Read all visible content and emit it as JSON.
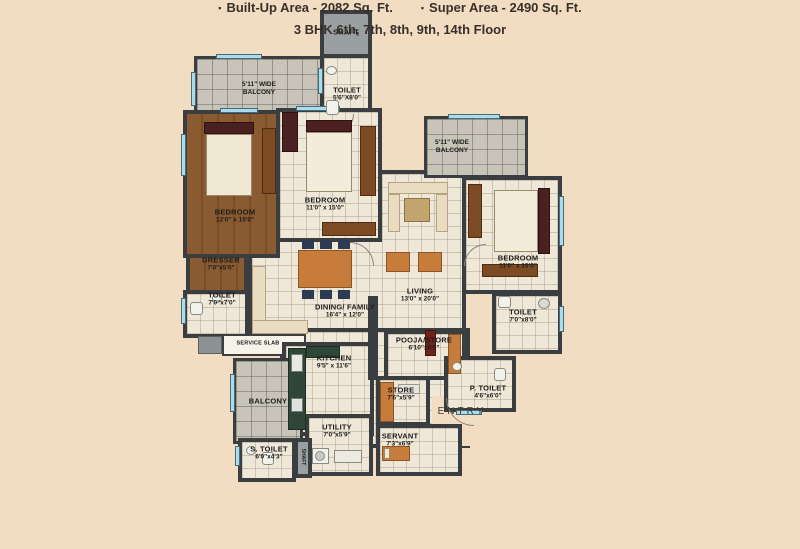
{
  "colors": {
    "background": "#f2dcc2",
    "wall": "#3a3e40",
    "tile_floor": "#efe8d9",
    "wood_floor": "#8a5a31",
    "balcony_floor": "#c8c4b9",
    "window": "#a9dcec",
    "shaft_fill": "#9aa0a2",
    "caption_text": "#38302a"
  },
  "rooms": {
    "shaft": {
      "name": "SHAFT"
    },
    "toilet_top": {
      "name": "TOILET",
      "dims": "5'6\"X8'0\""
    },
    "balcony_top": {
      "line1": "5'11\" WIDE",
      "line2": "BALCONY"
    },
    "balcony_right": {
      "line1": "5'11\" WIDE",
      "line2": "BALCONY"
    },
    "bedroom_left": {
      "name": "BEDROOM",
      "dims": "12'0\" x 15'0\""
    },
    "bedroom_mid": {
      "name": "BEDROOM",
      "dims": "11'0\" x 15'0\""
    },
    "bedroom_right": {
      "name": "BEDROOM",
      "dims": "11'0\" x 15'0\""
    },
    "dresser": {
      "name": "DRESSER",
      "dims": "7'0\"x5'0\""
    },
    "toilet_left": {
      "name": "TOILET",
      "dims": "7'0\"x7'0\""
    },
    "service_slab": {
      "name": "SERVICE SLAB"
    },
    "living": {
      "name": "LIVING",
      "dims": "13'0\" x 20'0\""
    },
    "dining": {
      "name": "DINING/ FAMILY",
      "dims": "16'4\" x 12'0\""
    },
    "kitchen": {
      "name": "KITCHEN",
      "dims": "9'5\" x 11'6\""
    },
    "pooja": {
      "name": "POOJA/STORE",
      "dims": "6'10\"x6'0\""
    },
    "store": {
      "name": "STORE",
      "dims": "7'6\"x5'9\""
    },
    "toilet_right": {
      "name": "TOILET",
      "dims": "7'0\"x8'0\""
    },
    "p_toilet": {
      "name": "P. TOILET",
      "dims": "4'6\"x6'0\""
    },
    "entry": {
      "name": "ENTRY"
    },
    "balcony_bottom": {
      "name": "BALCONY"
    },
    "utility": {
      "name": "UTILITY",
      "dims": "7'0\"x5'9\""
    },
    "servant": {
      "name": "SERVANT",
      "dims": "7'3\"x6'9\""
    },
    "s_toilet": {
      "name": "S. TOILET",
      "dims": "6'0\"x4'3\""
    },
    "shaft_bottom": {
      "name": "SHAFT"
    }
  },
  "caption": {
    "bullet": "▪",
    "built_up_area": "Built-Up Area - 2082 Sq. Ft.",
    "super_area": "Super Area - 2490 Sq. Ft.",
    "floors": "3 BHK 6th, 7th, 8th, 9th, 14th Floor"
  }
}
